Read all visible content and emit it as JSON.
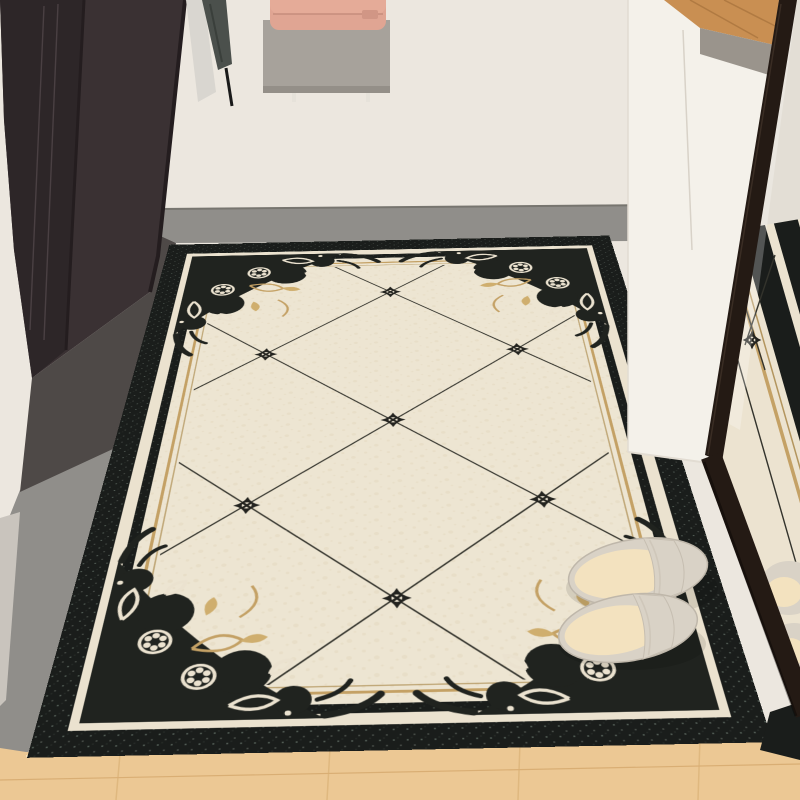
{
  "meta": {
    "type": "product-lifestyle-photo",
    "subject": "Decorative entryway floor mat with black ornate border and diamond lattice, beside a leaning floor mirror, slippers on the mat",
    "canvas": {
      "width": 800,
      "height": 800
    }
  },
  "scene": {
    "wall": {
      "color": "#ece7df",
      "shade": "#e4dfd6"
    },
    "entry_floor": {
      "color": "#908e8a",
      "shadow": "#4e4947",
      "edge": "#77756f"
    },
    "baseboard": {
      "color": "#c9c4bd"
    },
    "wood_floor": {
      "color": "#ecc894",
      "plank_line": "#d9ae74",
      "joint": "#dfb87f",
      "highlight": "#f7e3bd",
      "accent": "#c98f52",
      "accent_line": "#b07a42"
    },
    "left_cabinet": {
      "color": "#3a3133",
      "side": "#2d2628",
      "edge": "#241d1f",
      "seam": "#4a4043"
    },
    "right_cabinet": {
      "color": "#f4f1ea",
      "seam": "#d8d2c8",
      "edge": "#e2dcd2",
      "top_band": "#9a948c"
    },
    "umbrella": {
      "color": "#4b504c",
      "fold": "#3a3f3b",
      "cover": "#d9d6d0",
      "rod": "#1a1a1a"
    },
    "wall_shelf": {
      "color": "#a7a29b",
      "lip": "#948f88",
      "pin": "#e6e2da"
    },
    "bag": {
      "color": "#e0a593",
      "flap": "#e5ab98",
      "seam": "#c68d7c",
      "clasp": "#d19685"
    },
    "mirror": {
      "frame": "#241a14",
      "frame_highlight": "#3a2d24",
      "glass_wall": "#e3ded5",
      "glass_shade": "rgba(0,0,0,0.18)"
    },
    "rug": {
      "field": "#ede5d2",
      "band_cream": "#ebe2cf",
      "ink": "#1a1d1b",
      "ornament_ink": "#20231f",
      "star_ink": "#23231f",
      "lattice": "#33332c",
      "gold": "#c4a165",
      "gold_hairline": "#b3955e",
      "gold_leaf": "#cfae6e",
      "marble_fleck": "#e3d7bd",
      "speck_light": "#a8b2a6",
      "speck_mid": "#6e7d72",
      "star_count": 7,
      "pattern": "diagonal diamond lattice with four-point stars, ornate damask corners, concave gold corner arcs"
    },
    "slippers": {
      "body": "#d9d2c6",
      "edge": "#bfb7aa",
      "insole": "#f3e2bf",
      "seam": "#cfc7ba"
    },
    "reflection": {
      "rug_cream": "#ece3d0",
      "wood": "#d9b57f"
    }
  }
}
